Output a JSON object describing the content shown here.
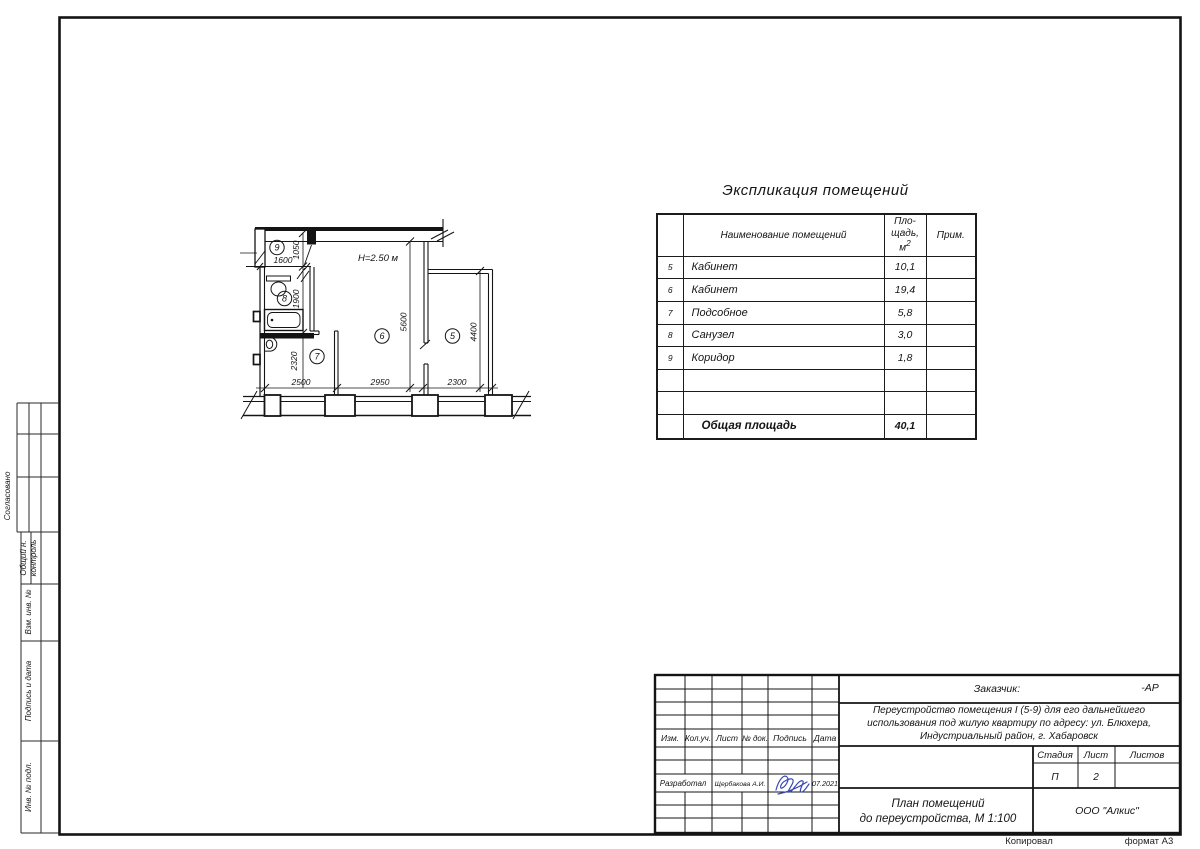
{
  "page": {
    "copied_label": "Копировал",
    "format_label": "формат  А3"
  },
  "side_strip": {
    "approved": "Согласовано",
    "control_1": "Общий н.",
    "control_2": "контроль",
    "replace_inv": "Взм. инв. №",
    "sign_date": "Подпись и дата",
    "inv_orig": "Инв. № подл."
  },
  "plan": {
    "height_note": "Н=2.50 м",
    "rooms": {
      "r5": "5",
      "r6": "6",
      "r7": "7",
      "r8": "8",
      "r9": "9"
    },
    "dims": {
      "d1600": "1600",
      "d1050": "1050",
      "d1900": "1900",
      "d2320": "2320",
      "d2500": "2500",
      "d2950": "2950",
      "d2300": "2300",
      "d5600": "5600",
      "d4400": "4400"
    }
  },
  "explication": {
    "title": "Экспликация помещений",
    "col_name": "Наименование помещений",
    "col_area_line1": "Пло-",
    "col_area_line2": "щадь,",
    "col_area_base": "м",
    "col_area_sup": "2",
    "col_note": "Прим.",
    "rows": [
      {
        "num": "5",
        "name": "Кабинет",
        "area": "10,1",
        "note": ""
      },
      {
        "num": "6",
        "name": "Кабинет",
        "area": "19,4",
        "note": ""
      },
      {
        "num": "7",
        "name": "Подсобное",
        "area": "5,8",
        "note": ""
      },
      {
        "num": "8",
        "name": "Санузел",
        "area": "3,0",
        "note": ""
      },
      {
        "num": "9",
        "name": "Коридор",
        "area": "1,8",
        "note": ""
      },
      {
        "num": "",
        "name": "",
        "area": "",
        "note": ""
      },
      {
        "num": "",
        "name": "",
        "area": "",
        "note": ""
      }
    ],
    "total_label": "Общая площадь",
    "total_area": "40,1"
  },
  "title_block": {
    "customer_label": "Заказчик:",
    "customer_value": "-АР",
    "project_line1": "Переустройство помещения I (5-9) для его дальнейшего",
    "project_line2": "использования под жилую квартиру по адресу: ул. Блюхера,",
    "project_line3": "Индустриальный район, г. Хабаровск",
    "col_izm": "Изм.",
    "col_koluch": "Кол.уч.",
    "col_list": "Лист",
    "col_ndok": "№ док.",
    "col_podpis": "Подпись",
    "col_data": "Дата",
    "developed_label": "Разработал",
    "developed_name": "Щербакова А.И.",
    "developed_date": "07.2021",
    "stage_label": "Стадия",
    "sheet_label": "Лист",
    "sheets_label": "Листов",
    "stage_value": "П",
    "sheet_value": "2",
    "sheets_value": "",
    "doc_title_line1": "План помещений",
    "doc_title_line2": "до переустройства, М 1:100",
    "company": "ООО \"Алкис\""
  }
}
